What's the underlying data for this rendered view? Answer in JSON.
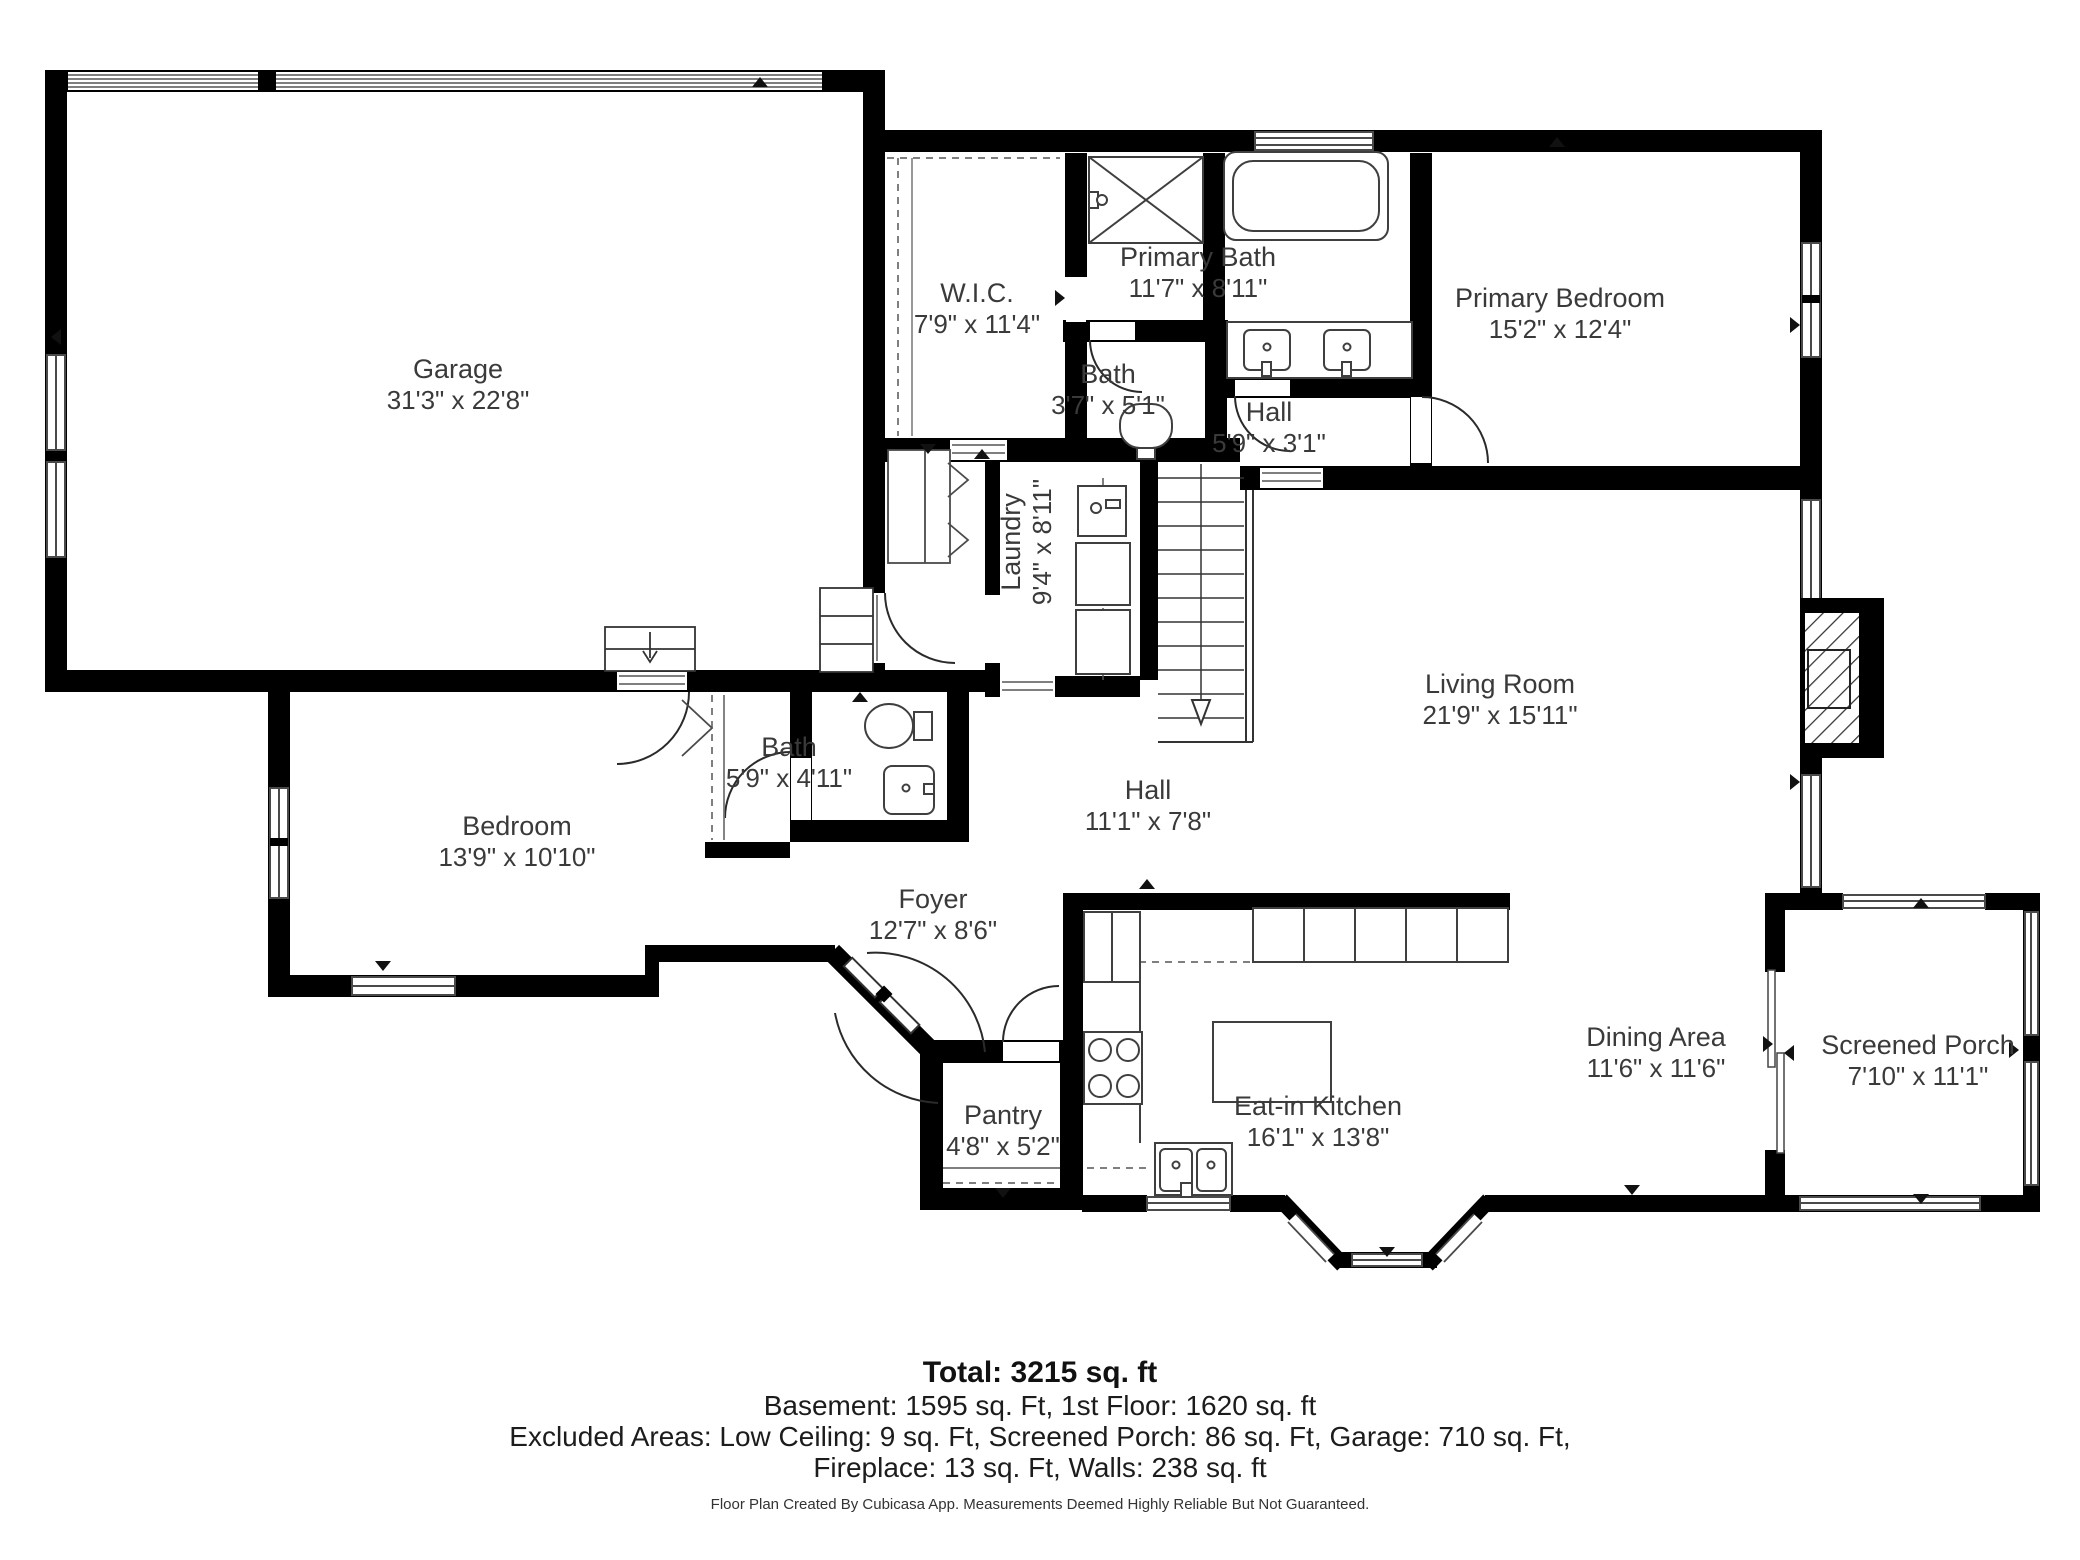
{
  "floor_plan": {
    "rooms": [
      {
        "name": "Garage",
        "dims": "31'3\" x 22'8\""
      },
      {
        "name": "W.I.C.",
        "dims": "7'9\" x 11'4\""
      },
      {
        "name": "Primary Bath",
        "dims": "11'7\" x 8'11\""
      },
      {
        "name": "Primary Bedroom",
        "dims": "15'2\" x 12'4\""
      },
      {
        "name": "Bath",
        "dims": "3'7\" x 5'1\""
      },
      {
        "name": "Hall",
        "dims": "5'9\" x 3'1\""
      },
      {
        "name": "Laundry",
        "dims": "9'4\" x 8'11\""
      },
      {
        "name": "Living Room",
        "dims": "21'9\" x 15'11\""
      },
      {
        "name": "Bedroom",
        "dims": "13'9\" x 10'10\""
      },
      {
        "name": "Bath",
        "dims": "5'9\" x 4'11\""
      },
      {
        "name": "Hall",
        "dims": "11'1\" x 7'8\""
      },
      {
        "name": "Foyer",
        "dims": "12'7\" x 8'6\""
      },
      {
        "name": "Pantry",
        "dims": "4'8\" x 5'2\""
      },
      {
        "name": "Eat-in Kitchen",
        "dims": "16'1\" x 13'8\""
      },
      {
        "name": "Dining Area",
        "dims": "11'6\" x 11'6\""
      },
      {
        "name": "Screened Porch",
        "dims": "7'10\" x 11'1\""
      }
    ],
    "summary": {
      "total": "Total: 3215 sq. ft",
      "floors": "Basement: 1595 sq. Ft, 1st Floor: 1620 sq. ft",
      "excluded": "Excluded Areas: Low Ceiling: 9 sq. Ft, Screened Porch: 86 sq. Ft, Garage: 710 sq. Ft,",
      "excluded2": "Fireplace: 13 sq. Ft, Walls: 238 sq. ft",
      "disclaimer": "Floor Plan Created By Cubicasa App. Measurements Deemed Highly Reliable But Not Guaranteed."
    },
    "colors": {
      "wall": "#000000",
      "text": "#3a3a3a"
    }
  }
}
